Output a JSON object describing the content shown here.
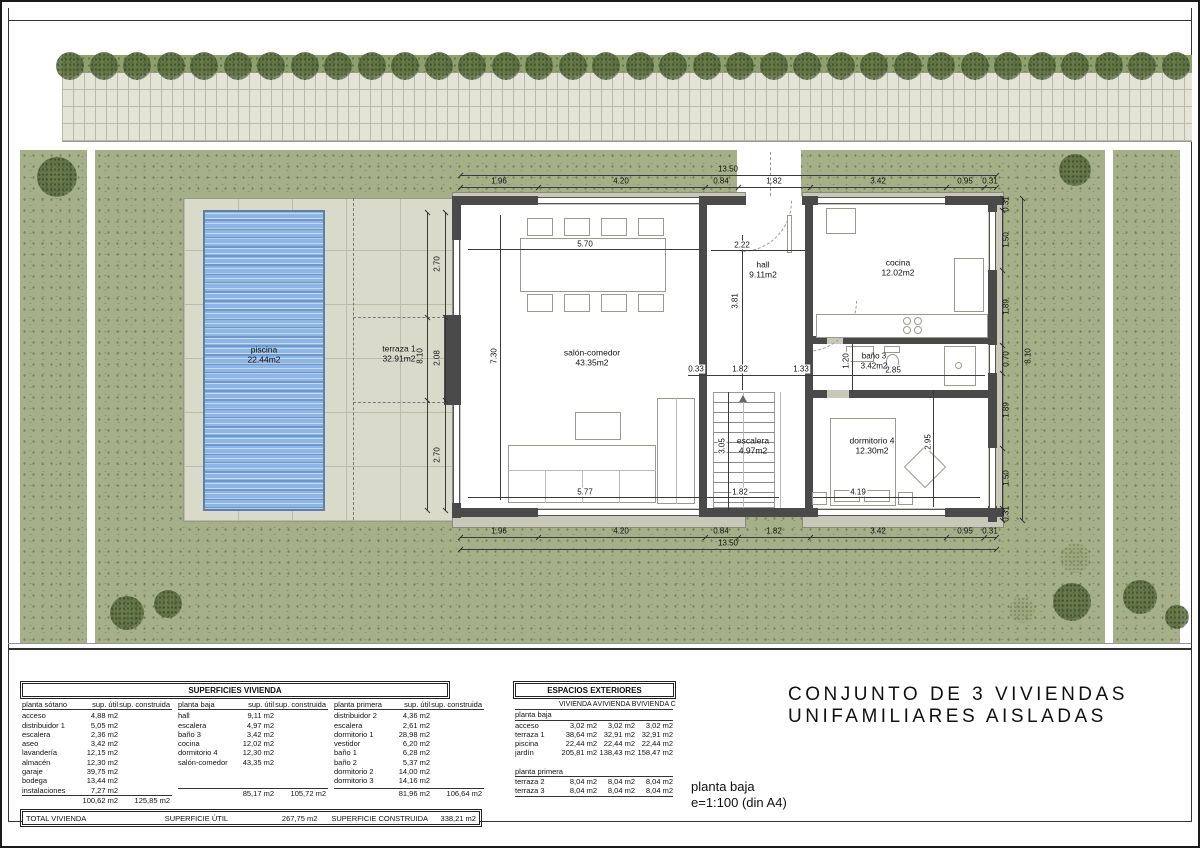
{
  "title": {
    "line1": "CONJUNTO DE 3 VIVIENDAS",
    "line2": "UNIFAMILIARES AISLADAS"
  },
  "plan_label": {
    "name": "planta baja",
    "scale": "e=1:100 (din A4)"
  },
  "colors": {
    "garden_green": "#a6b088",
    "tree_band_green": "#8fa06f",
    "paving": "#e3e3d6",
    "deck": "#dadacb",
    "pool_water": "#8db6e4",
    "wall_dark": "#4a4a4a",
    "wall_pad": "#c9c9ba"
  },
  "plan": {
    "rooms": {
      "salon": {
        "name": "salón-comedor",
        "area": "43.35m2"
      },
      "hall": {
        "name": "hall",
        "area": "9.11m2"
      },
      "cocina": {
        "name": "cocina",
        "area": "12.02m2"
      },
      "bano3": {
        "name": "baño 3",
        "area": "3.42m2"
      },
      "escalera": {
        "name": "escalera",
        "area": "4.97m2"
      },
      "dormitorio4": {
        "name": "dormitorio 4",
        "area": "12.30m2"
      },
      "piscina": {
        "name": "piscina",
        "area": "22.44m2"
      },
      "terraza1": {
        "name": "terraza 1",
        "area": "32.91m2"
      }
    },
    "dims": {
      "top_overall": "13.50",
      "bottom_overall": "13.50",
      "top_segments": [
        "1.96",
        "4.20",
        "0.84",
        "1.82",
        "3.42",
        "0.95",
        "0.31"
      ],
      "bottom_segments": [
        "1.96",
        "4.20",
        "0.84",
        "1.82",
        "3.42",
        "0.95",
        "0.31"
      ],
      "left_overall": "8.10",
      "left_segments": [
        "2.70",
        "2.08",
        "2.70"
      ],
      "right_overall": "8.10",
      "right_segments": [
        "0.31",
        "1.50",
        "1.89",
        "0.70",
        "1.89",
        "1.50",
        "0.31"
      ],
      "interior": {
        "salon_top_w": "5.70",
        "salon_h": "7.30",
        "hall_w": "2.22",
        "hall_h": "3.81",
        "mid_a": "0.33",
        "mid_b": "1.82",
        "mid_c": "1.33",
        "bano_h": "1.20",
        "bano_w": "2.85",
        "stairs_h": "3.05",
        "salon_bottom_w": "5.77",
        "stairs_w": "1.82",
        "dorm_w": "4.19",
        "dorm_h": "2.95"
      }
    }
  },
  "tables": {
    "superficies": {
      "title": "SUPERFICIES VIVIENDA",
      "col_util": "sup. útil",
      "col_constr": "sup. construida",
      "sections": [
        {
          "name": "planta sótano",
          "rows": [
            [
              "acceso",
              "4,88 m2"
            ],
            [
              "distribuidor 1",
              "5,05 m2"
            ],
            [
              "escalera",
              "2,36 m2"
            ],
            [
              "aseo",
              "3,42 m2"
            ],
            [
              "lavandería",
              "12,15 m2"
            ],
            [
              "almacén",
              "12,30 m2"
            ],
            [
              "garaje",
              "39,75 m2"
            ],
            [
              "bodega",
              "13,44 m2"
            ],
            [
              "instalaciones",
              "7,27 m2"
            ]
          ],
          "total_util": "100,62 m2",
          "total_constr": "125,85 m2"
        },
        {
          "name": "planta baja",
          "rows": [
            [
              "hall",
              "9,11 m2"
            ],
            [
              "escalera",
              "4,97 m2"
            ],
            [
              "baño 3",
              "3,42 m2"
            ],
            [
              "cocina",
              "12,02 m2"
            ],
            [
              "dormitorio 4",
              "12,30 m2"
            ],
            [
              "salón-comedor",
              "43,35 m2"
            ]
          ],
          "total_util": "85,17 m2",
          "total_constr": "105,72 m2"
        },
        {
          "name": "planta primera",
          "rows": [
            [
              "distribuidor 2",
              "4,36 m2"
            ],
            [
              "escalera",
              "2,61 m2"
            ],
            [
              "dormitorio 1",
              "28,98 m2"
            ],
            [
              "vestidor",
              "6,20 m2"
            ],
            [
              "baño 1",
              "6,28 m2"
            ],
            [
              "baño 2",
              "5,37 m2"
            ],
            [
              "dormitorio 2",
              "14,00 m2"
            ],
            [
              "dormitorio 3",
              "14,16 m2"
            ]
          ],
          "total_util": "81,96 m2",
          "total_constr": "106,64 m2"
        }
      ]
    },
    "exteriores": {
      "title": "ESPACIOS EXTERIORES",
      "col_headers": [
        "VIVIENDA A",
        "VIVIENDA B",
        "VIVIENDA C"
      ],
      "groups": [
        {
          "name": "planta baja",
          "rows": [
            [
              "acceso",
              "3,02 m2",
              "3,02 m2",
              "3,02 m2"
            ],
            [
              "terraza 1",
              "38,64 m2",
              "32,91 m2",
              "32,91 m2"
            ],
            [
              "piscina",
              "22,44 m2",
              "22,44 m2",
              "22,44 m2"
            ],
            [
              "jardín",
              "205,81 m2",
              "138,43 m2",
              "158,47 m2"
            ]
          ]
        },
        {
          "name": "planta primera",
          "rows": [
            [
              "terraza 2",
              "8,04 m2",
              "8,04 m2",
              "8,04 m2"
            ],
            [
              "terraza 3",
              "8,04 m2",
              "8,04 m2",
              "8,04 m2"
            ]
          ]
        }
      ]
    },
    "total": {
      "label": "TOTAL VIVIENDA",
      "util_label": "SUPERFICIE ÚTIL",
      "util_value": "267,75 m2",
      "constr_label": "SUPERFICIE CONSTRUIDA",
      "constr_value": "338,21 m2"
    }
  }
}
